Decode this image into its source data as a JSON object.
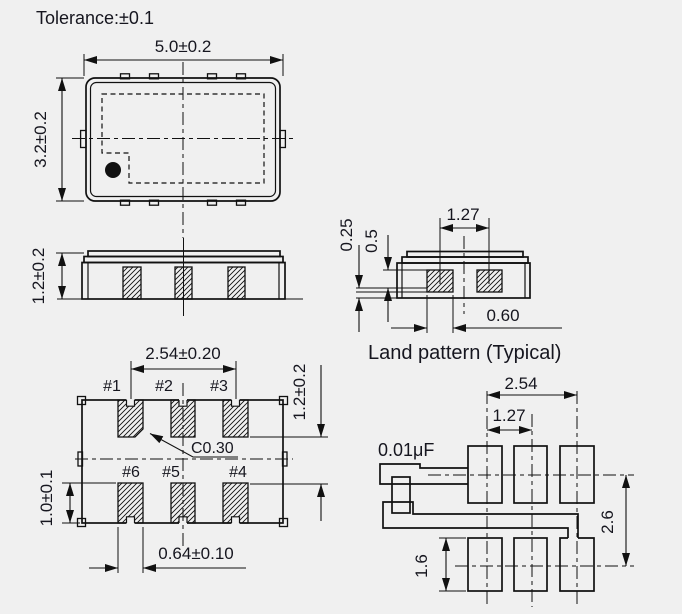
{
  "title": "Tolerance:±0.1",
  "top_view": {
    "width_dim": "5.0±0.2",
    "height_dim": "3.2±0.2"
  },
  "side_view": {
    "height_dim": "1.2±0.2"
  },
  "mount_view": {
    "land_clearance_dim": "0.25",
    "land_height_dim": "0.5",
    "pitch_dim": "1.27",
    "pad_width_dim": "0.60",
    "caption": "Land pattern (Typical)"
  },
  "bottom_view": {
    "pitch_dim": "2.54±0.20",
    "row_gap_dim": "1.2±0.2",
    "chamfer_dim": "C0.30",
    "pad_height_dim": "1.0±0.1",
    "pad_width_dim": "0.64±0.10",
    "pads": {
      "p1": "#1",
      "p2": "#2",
      "p3": "#3",
      "p6": "#6",
      "p5": "#5",
      "p4": "#4"
    }
  },
  "land_pattern": {
    "outer_pitch_dim": "2.54",
    "pitch_dim": "1.27",
    "capacitor_label": "0.01μF",
    "row_pitch_dim": "2.6",
    "pad_height_dim": "1.6"
  },
  "colors": {
    "background": "#f0f0f0",
    "line": "#111111",
    "text": "#16161f"
  }
}
